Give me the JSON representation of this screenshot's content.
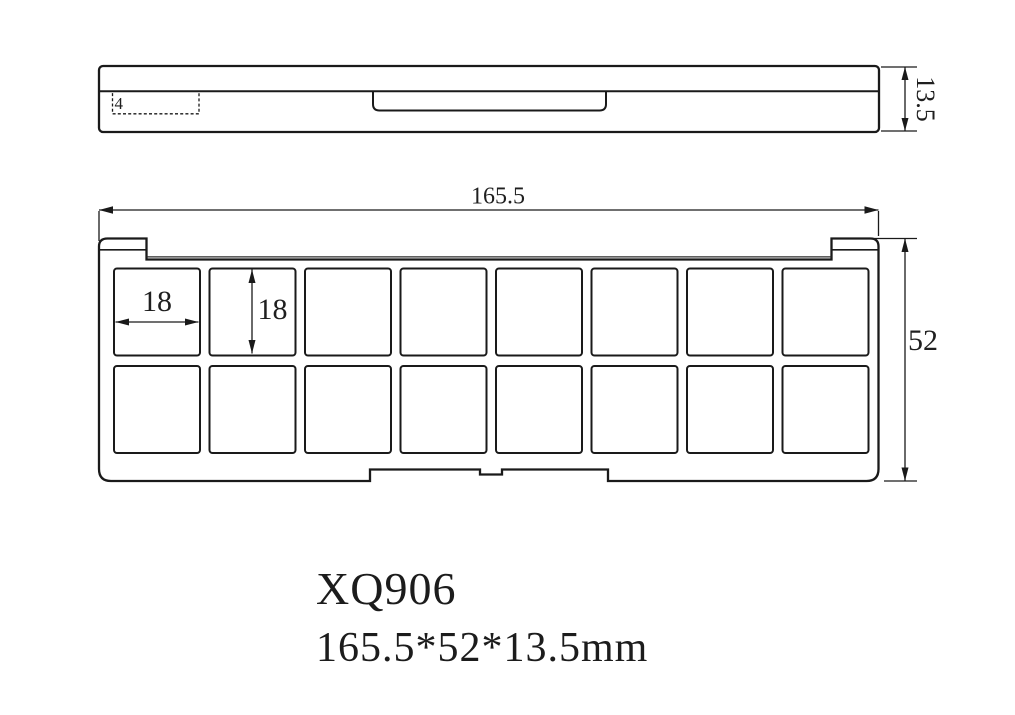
{
  "title_block": {
    "model": "XQ906",
    "size_text": "165.5*52*13.5mm"
  },
  "colors": {
    "line": "#1a1a1a",
    "text": "#1c1c1c",
    "background": "#ffffff"
  },
  "side_view": {
    "thickness_dim": "13.5",
    "detail_dim": "4"
  },
  "top_view": {
    "overall_width_dim": "165.5",
    "overall_height_dim": "52",
    "pan_width_dim": "18",
    "pan_height_dim": "18",
    "grid": {
      "rows": 2,
      "cols": 8
    }
  }
}
